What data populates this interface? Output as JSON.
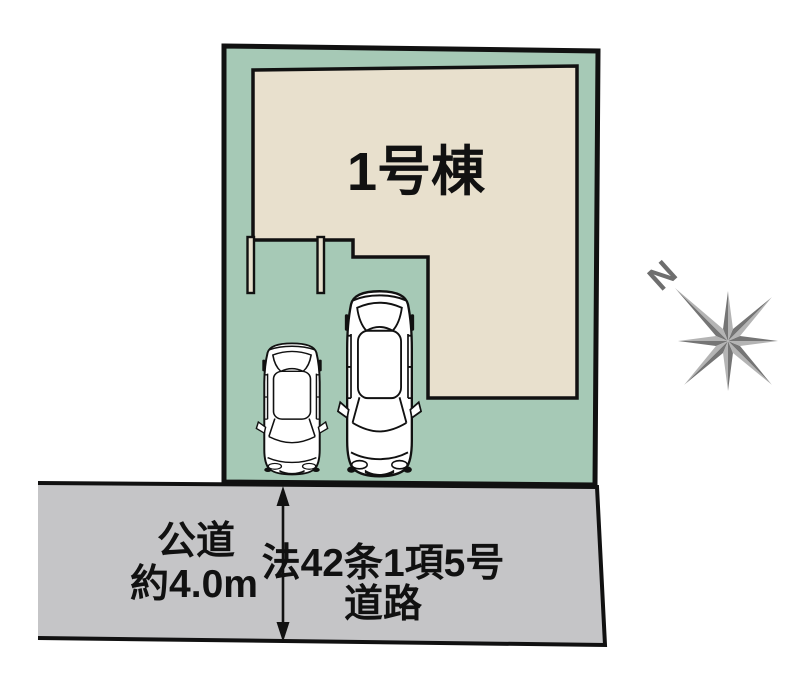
{
  "plot": {
    "building_label": "1号棟"
  },
  "road": {
    "type_label": "公道",
    "width_label": "約4.0m",
    "name_line1": "法42条1項5号",
    "name_line2": "道路"
  },
  "compass": {
    "north_label": "N"
  },
  "colors": {
    "plot_fill": "#a6c9b6",
    "building_fill": "#e8e0cd",
    "road_fill": "#c5c5c7",
    "outline": "#111111",
    "compass_dark": "#757575",
    "compass_light": "#b4b4b4",
    "compass_text": "#6e6e6e",
    "car_fill": "#ffffff"
  }
}
